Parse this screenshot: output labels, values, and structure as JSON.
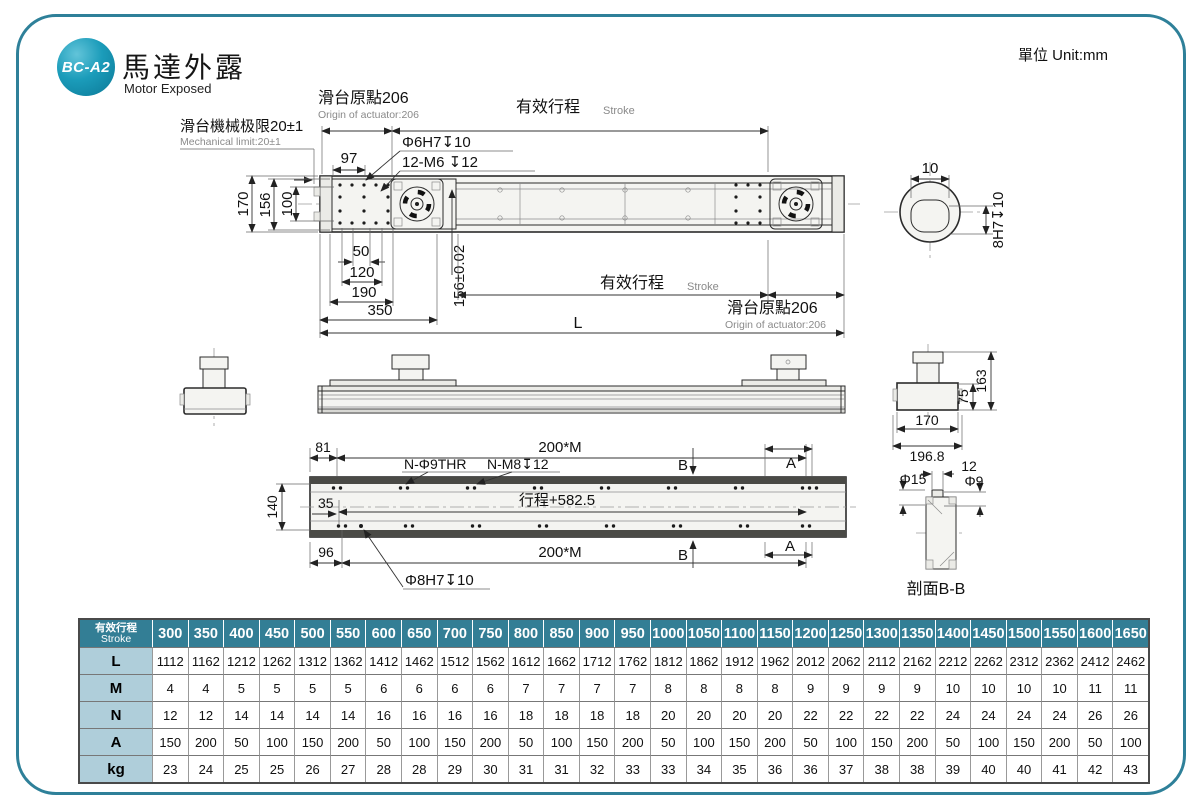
{
  "header": {
    "badge": "BC-A2",
    "title_zh": "馬達外露",
    "title_en": "Motor Exposed",
    "unit": "單位 Unit:mm"
  },
  "colors": {
    "teal": "#337E95",
    "badge": "#1B9CBA",
    "label_bg": "#AFCEDA",
    "border": "#2E8099"
  },
  "plan_view": {
    "origin_zh": "滑台原點206",
    "origin_en": "Origin of actuator:206",
    "stroke_zh": "有效行程",
    "stroke_en": "Stroke",
    "limit_zh": "滑台機械极限20±1",
    "limit_en": "Mechanical limit:20±1",
    "d97": "97",
    "hole1": "Φ6H7↧10",
    "hole2": "12-M6 ↧12",
    "d170": "170",
    "d156": "156",
    "d100": "100",
    "d50": "50",
    "d120": "120",
    "d190": "190",
    "d350": "350",
    "d156t": "156±0.02",
    "stroke2_zh": "有效行程",
    "stroke2_en": "Stroke",
    "origin2_zh": "滑台原點206",
    "origin2_en": "Origin of actuator:206",
    "dL": "L"
  },
  "end_view": {
    "d10": "10",
    "d8h7": "8H7↧10"
  },
  "side_view": {
    "d163": "163",
    "d75": "75",
    "d170": "170",
    "d196": "196.8"
  },
  "bottom_view": {
    "d81": "81",
    "d200m": "200*M",
    "n_phi9": "N-Φ9THR",
    "n_m8": "N-M8↧12",
    "bB": "B",
    "bA": "A",
    "d140": "140",
    "d35": "35",
    "travel": "行程+582.5",
    "d96": "96",
    "d200m2": "200*M",
    "bB2": "B",
    "bA2": "A",
    "phi8": "Φ8H7↧10"
  },
  "section_view": {
    "phi15": "Φ15",
    "d12": "12",
    "phi9": "Φ9",
    "caption": "剖面B-B"
  },
  "table": {
    "header_zh": "有效行程",
    "header_en": "Stroke",
    "strokes": [
      300,
      350,
      400,
      450,
      500,
      550,
      600,
      650,
      700,
      750,
      800,
      850,
      900,
      950,
      1000,
      1050,
      1100,
      1150,
      1200,
      1250,
      1300,
      1350,
      1400,
      1450,
      1500,
      1550,
      1600,
      1650
    ],
    "rows": [
      {
        "label": "L",
        "values": [
          1112,
          1162,
          1212,
          1262,
          1312,
          1362,
          1412,
          1462,
          1512,
          1562,
          1612,
          1662,
          1712,
          1762,
          1812,
          1862,
          1912,
          1962,
          2012,
          2062,
          2112,
          2162,
          2212,
          2262,
          2312,
          2362,
          2412,
          2462
        ]
      },
      {
        "label": "M",
        "values": [
          4,
          4,
          5,
          5,
          5,
          5,
          6,
          6,
          6,
          6,
          7,
          7,
          7,
          7,
          8,
          8,
          8,
          8,
          9,
          9,
          9,
          9,
          10,
          10,
          10,
          10,
          11,
          11
        ]
      },
      {
        "label": "N",
        "values": [
          12,
          12,
          14,
          14,
          14,
          14,
          16,
          16,
          16,
          16,
          18,
          18,
          18,
          18,
          20,
          20,
          20,
          20,
          22,
          22,
          22,
          22,
          24,
          24,
          24,
          24,
          26,
          26
        ]
      },
      {
        "label": "A",
        "values": [
          150,
          200,
          50,
          100,
          150,
          200,
          50,
          100,
          150,
          200,
          50,
          100,
          150,
          200,
          50,
          100,
          150,
          200,
          50,
          100,
          150,
          200,
          50,
          100,
          150,
          200,
          50,
          100
        ]
      },
      {
        "label": "kg",
        "values": [
          23,
          24,
          25,
          25,
          26,
          27,
          28,
          28,
          29,
          30,
          31,
          31,
          32,
          33,
          33,
          34,
          35,
          36,
          36,
          37,
          38,
          38,
          39,
          40,
          40,
          41,
          42,
          43
        ]
      }
    ]
  }
}
